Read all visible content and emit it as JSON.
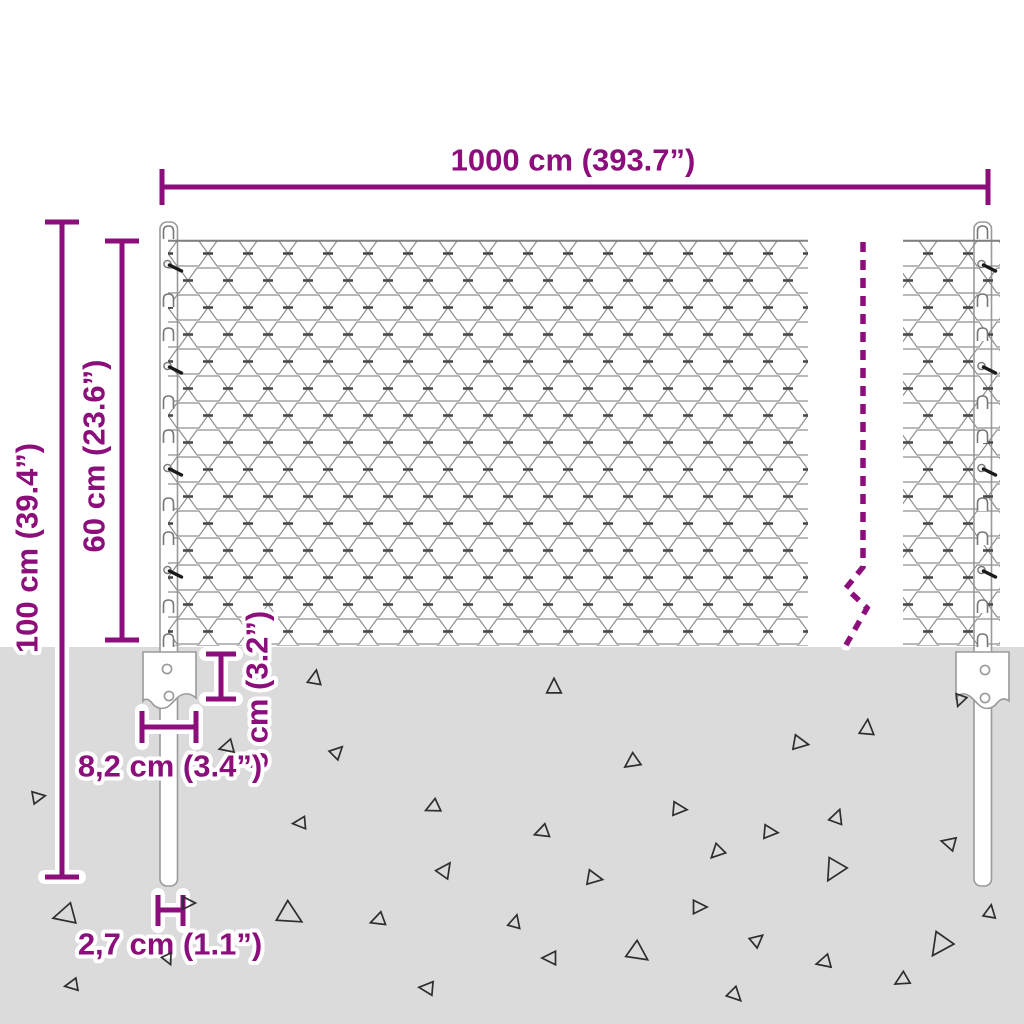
{
  "diagram": {
    "labels": {
      "total_width": "1000 cm (393.7”)",
      "post_height": "100 cm (39.4”)",
      "mesh_height": "60 cm (23.6”)",
      "anchor_depth": "8 cm (3.2”)",
      "anchor_width": "8,2 cm (3.4”)",
      "post_diameter": "2,7 cm (1.1”)"
    },
    "colors": {
      "dimension": "#8B0E7B",
      "ground": "#DBDBDB",
      "mesh_line": "#8F8F8F",
      "steel_outline": "#9A9A9A"
    },
    "ground": {
      "triangles": [
        [
          315,
          678,
          13,
          10
        ],
        [
          554,
          687,
          14,
          0
        ],
        [
          960,
          700,
          11,
          200
        ],
        [
          227,
          747,
          13,
          255
        ],
        [
          337,
          752,
          12,
          45
        ],
        [
          867,
          728,
          14,
          5
        ],
        [
          800,
          743,
          14,
          100
        ],
        [
          632,
          762,
          14,
          235
        ],
        [
          38,
          797,
          12,
          80
        ],
        [
          679,
          809,
          13,
          95
        ],
        [
          300,
          823,
          12,
          265
        ],
        [
          433,
          807,
          13,
          245
        ],
        [
          542,
          832,
          13,
          250
        ],
        [
          770,
          832,
          13,
          95
        ],
        [
          837,
          817,
          13,
          20
        ],
        [
          717,
          852,
          13,
          225
        ],
        [
          949,
          843,
          13,
          285
        ],
        [
          445,
          870,
          14,
          35
        ],
        [
          65,
          915,
          20,
          255
        ],
        [
          290,
          915,
          22,
          120
        ],
        [
          378,
          920,
          13,
          250
        ],
        [
          188,
          903,
          12,
          90
        ],
        [
          168,
          959,
          10,
          155
        ],
        [
          72,
          985,
          12,
          260
        ],
        [
          427,
          988,
          13,
          275
        ],
        [
          594,
          878,
          14,
          100
        ],
        [
          834,
          870,
          20,
          210
        ],
        [
          699,
          907,
          13,
          90
        ],
        [
          515,
          922,
          12,
          15
        ],
        [
          757,
          940,
          12,
          50
        ],
        [
          550,
          958,
          13,
          270
        ],
        [
          638,
          953,
          19,
          125
        ],
        [
          824,
          962,
          13,
          255
        ],
        [
          940,
          945,
          21,
          215
        ],
        [
          902,
          980,
          13,
          240
        ],
        [
          990,
          912,
          12,
          10
        ],
        [
          735,
          995,
          13,
          135
        ]
      ]
    }
  }
}
